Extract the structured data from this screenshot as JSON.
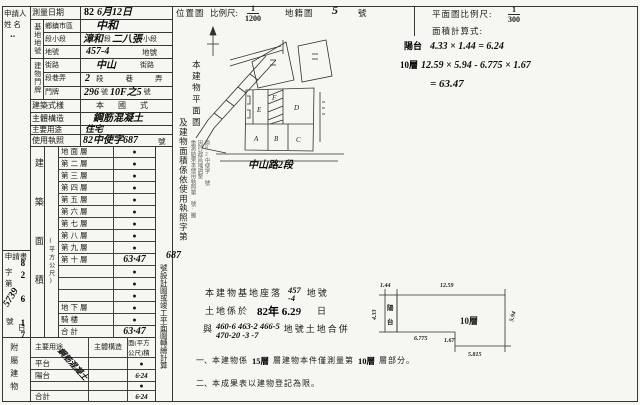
{
  "left": {
    "applicant_label": "申請人",
    "applicant_name_label": "姓 名",
    "applicant_mark": "‥",
    "application": {
      "label": "申請書",
      "no_prefix": "字第",
      "no": "5739",
      "no_suffix": "號",
      "date": "82 6 17",
      "date_suffix": "日"
    },
    "annex_label": "附屬建物"
  },
  "survey": {
    "date_label": "測量日期",
    "date_stamp": "82",
    "date_hw": "6月12日"
  },
  "site": {
    "group_label": "基地地號",
    "district_label": "鄉鎮市區",
    "district_value": "中和",
    "section_label": "段小段",
    "section_hw1": "漳和",
    "section_print1": "段",
    "section_hw2": "二八張",
    "section_print2": "小段",
    "lot_label": "地號",
    "lot_value": "457-4",
    "lot_suffix": "地號"
  },
  "door": {
    "group_label": "建物門牌",
    "street_label": "街路",
    "street_value": "中山",
    "street_suffix": "街路",
    "lane_label": "段巷弄",
    "lane_value": "2",
    "lane_suffix": "段巷弄",
    "plate_label": "門牌",
    "plate_value": "296",
    "plate_mid": "號",
    "plate_value2": "10F之5",
    "plate_suffix": "號"
  },
  "building": {
    "style_label": "建築式樣",
    "style_value": "本國式",
    "structure_label": "主體構造",
    "structure_value": "鋼筋混凝土",
    "use_label": "主要用途",
    "use_value": "住宅",
    "license_label": "使用執照",
    "license_value": "82中使字687",
    "license_suffix": "號"
  },
  "floor_table": {
    "col_label": "建築面積",
    "col_sublabel": "(平方公尺)",
    "rows": [
      {
        "label": "地面層",
        "value": "●"
      },
      {
        "label": "第二層",
        "value": "●"
      },
      {
        "label": "第三層",
        "value": "●"
      },
      {
        "label": "第四層",
        "value": "●"
      },
      {
        "label": "第五層",
        "value": "●"
      },
      {
        "label": "第六層",
        "value": "●"
      },
      {
        "label": "第七層",
        "value": "●"
      },
      {
        "label": "第八層",
        "value": "●"
      },
      {
        "label": "第九層",
        "value": "●"
      },
      {
        "label": "第十層",
        "value": "63·47"
      },
      {
        "label": "",
        "value": "●"
      },
      {
        "label": "",
        "value": "●"
      },
      {
        "label": "",
        "value": "●"
      },
      {
        "label": "地下層",
        "value": "●"
      },
      {
        "label": "騎樓",
        "value": "●"
      },
      {
        "label": "合計",
        "value": "63·47"
      }
    ]
  },
  "annex_table": {
    "headers": {
      "use": "主要用途",
      "structure": "主體構造",
      "area": "面(平方公尺)積"
    },
    "structure_hw": "鋼筋混凝土",
    "rows": [
      {
        "use": "平台",
        "area": "●"
      },
      {
        "use": "陽台",
        "area": "6·24"
      },
      {
        "use": "",
        "area": "●"
      },
      {
        "use": "合計",
        "area": "6·24"
      }
    ]
  },
  "middle_header": {
    "location_label": "位置圖",
    "scale_label": "比例尺:",
    "num": "1",
    "den": "1200",
    "cadastral_label": "地籍圖",
    "cadastral_no": "5",
    "cadastral_suffix": "號"
  },
  "right_header": {
    "plan_scale_label": "平面圖比例尺:",
    "num": "1",
    "den": "300",
    "calc_label": "面積計算式:"
  },
  "calc": {
    "l1_prefix": "陽台",
    "l1": "4.33 × 1.44 = 6.24",
    "l2_prefix": "10層",
    "l2": "12.59 × 5.94 - 6.775 × 1.67",
    "l3": "= 63.47"
  },
  "vertical_note": {
    "col1": "本建物平面圖",
    "col2": "及建物面積係依使用執照字第",
    "hw_no": "687",
    "col3": "號設計圖或竣工平面圖轉繪計算"
  },
  "stamp_note": {
    "cols": [
      "重測結果本使用執照第 號·騰",
      "因行政區域調整",
      "原82中使字 號"
    ]
  },
  "map": {
    "parcels": [
      "E",
      "F",
      "D",
      "A",
      "B",
      "C"
    ],
    "road_label": "中山路2段"
  },
  "ground": {
    "l1_pre": "本建物基地座落",
    "l1_no_top": "457",
    "l1_no_bottom": "-4",
    "l1_suf": "地號",
    "l2_pre": "土地係於",
    "l2_date": "82年 6.2",
    "l2_date_hw": "9",
    "l2_suf": "日",
    "l3_pre": "與",
    "l3_nums1": "460-6 463-2 466-5",
    "l3_nums2": "470-20 -3 -7",
    "l3_suf": "地號土地合併"
  },
  "footnotes": {
    "n1_bullet": "一、",
    "n1_pre": "本建物係",
    "n1_stamp1": "15層",
    "n1_mid": "層建物本件僅測量第",
    "n1_stamp2": "10層",
    "n1_suf": "層部分。",
    "n2_bullet": "二、",
    "n2_text": "本成果表以建物登記為限。"
  },
  "plan": {
    "label": "10層",
    "balcony_top": "陽",
    "balcony_bottom": "台",
    "dims": {
      "balcony_w": "1.44",
      "top": "12.59",
      "left": "4.33",
      "bottom_left": "6.775",
      "notch": "1.67",
      "bottom_right": "5.815",
      "right": "5.94"
    }
  }
}
